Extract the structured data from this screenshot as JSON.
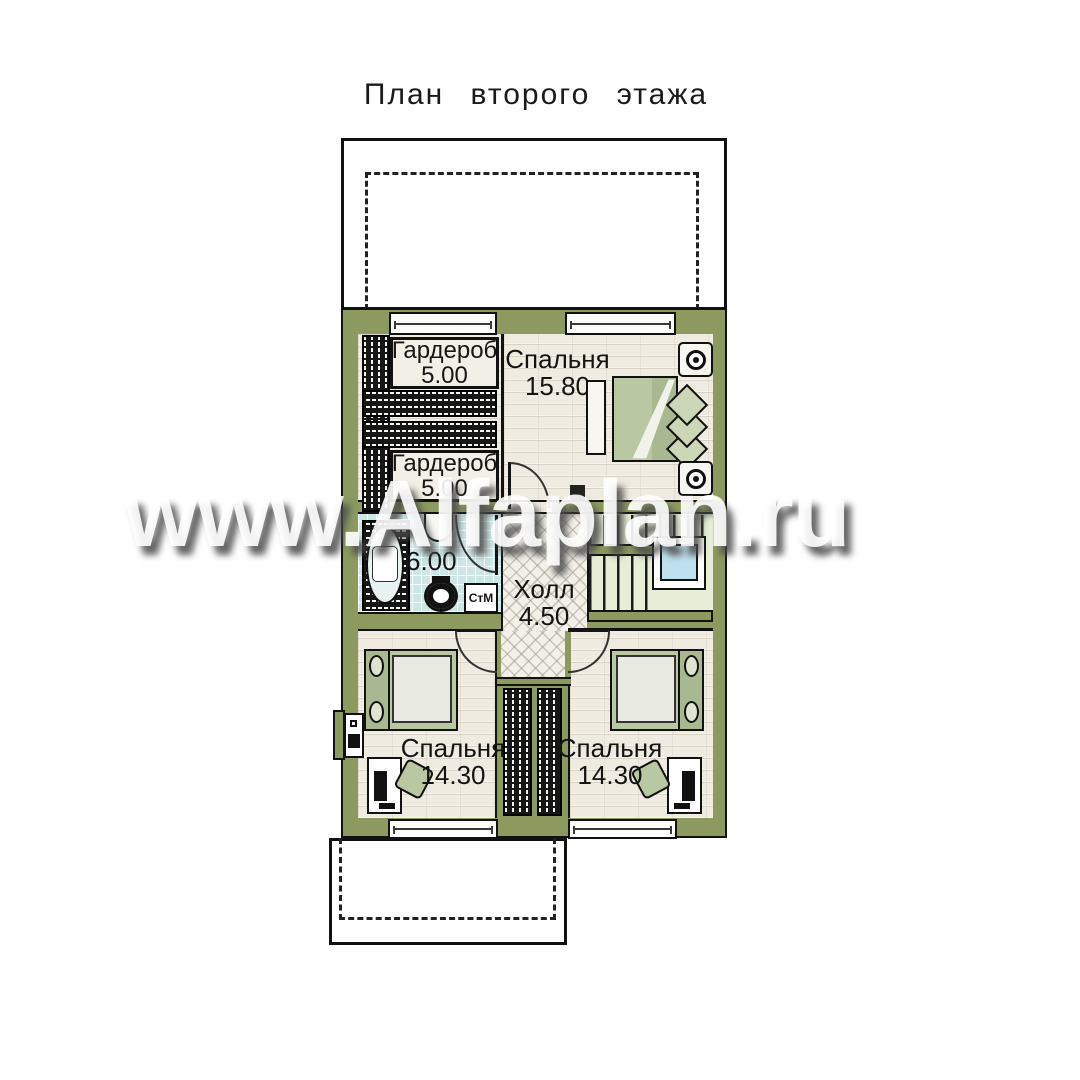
{
  "title": "План второго этажа",
  "watermark": "www.Alfaplan.ru",
  "rooms": {
    "wardrobe_top": {
      "name": "Гардероб",
      "area": "5.00"
    },
    "wardrobe_bottom": {
      "name": "Гардероб",
      "area": "5.00"
    },
    "bedroom_top": {
      "name": "Спальня",
      "area": "15.80"
    },
    "bathroom": {
      "area": "6.00"
    },
    "hall": {
      "name": "Холл",
      "area": "4.50"
    },
    "bedroom_left": {
      "name": "Спальня",
      "area": "14.30"
    },
    "bedroom_right": {
      "name": "Спальня",
      "area": "14.30"
    }
  },
  "appliances": {
    "washing_machine": "СтМ"
  },
  "colors": {
    "wall": "#8c9a60",
    "floor": "#efebe1",
    "bathroom_floor": "#cde7e6",
    "stairs": "#e6eed8",
    "bed_green": "#b9c7a3",
    "window_glass": "#bfe0ee"
  }
}
